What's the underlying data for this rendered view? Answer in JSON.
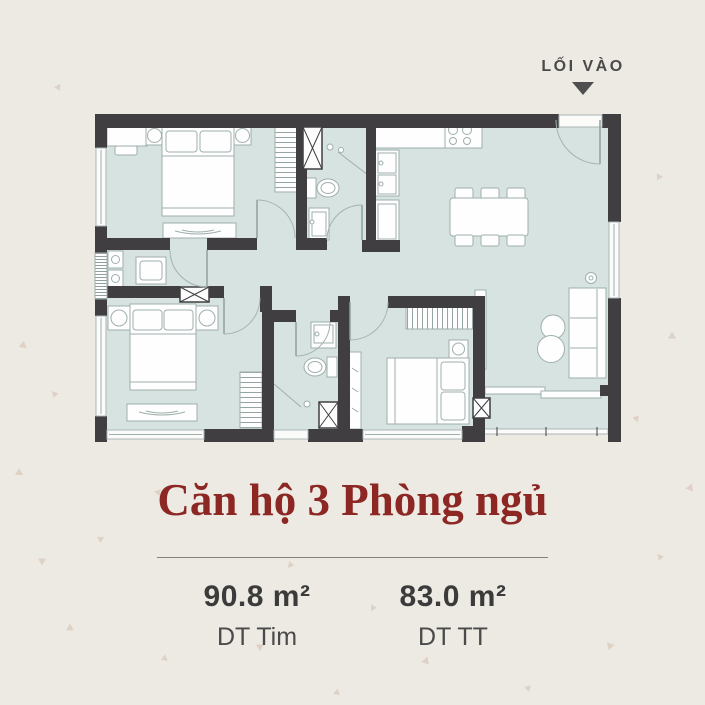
{
  "entrance": {
    "label": "LỐI VÀO"
  },
  "title": "Căn hộ 3 Phòng ngủ",
  "areas": [
    {
      "value": "90.8 m²",
      "label": "DT Tim"
    },
    {
      "value": "83.0 m²",
      "label": "DT TT"
    }
  ],
  "colors": {
    "background": "#EDEAE4",
    "room_fill": "#D7E3E0",
    "wall": "#403E41",
    "accent_red": "#8C2723",
    "text_dark": "#3B3B3B",
    "text_medium": "#4A4A4A",
    "furniture_stroke": "#9FAFAD",
    "triangle_decor": "#CDB6A2"
  }
}
